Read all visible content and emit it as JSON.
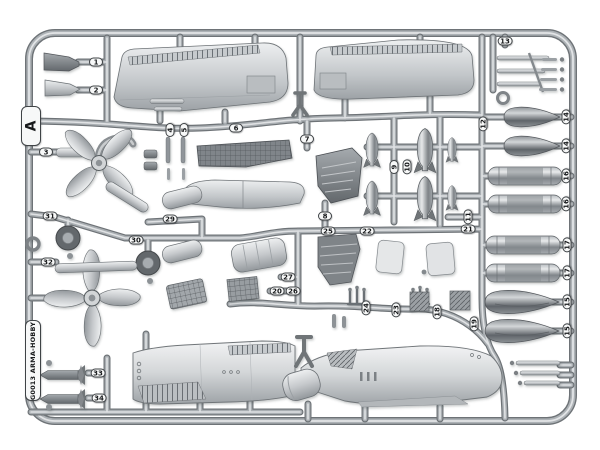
{
  "sprue": {
    "letter": "A",
    "product_code": "G0013 ARMA-HOBBY",
    "part_tags": [
      {
        "label": "1",
        "x": 96,
        "y": 62,
        "rot": 0
      },
      {
        "label": "2",
        "x": 96,
        "y": 90,
        "rot": 0
      },
      {
        "label": "3",
        "x": 46,
        "y": 152,
        "rot": 0
      },
      {
        "label": "4",
        "x": 170,
        "y": 130,
        "rot": 1
      },
      {
        "label": "5",
        "x": 184,
        "y": 130,
        "rot": 1
      },
      {
        "label": "6",
        "x": 236,
        "y": 128,
        "rot": 0
      },
      {
        "label": "7",
        "x": 307,
        "y": 139,
        "rot": 0
      },
      {
        "label": "8",
        "x": 325,
        "y": 216,
        "rot": 0
      },
      {
        "label": "9",
        "x": 394,
        "y": 167,
        "rot": 1
      },
      {
        "label": "10",
        "x": 407,
        "y": 167,
        "rot": 1
      },
      {
        "label": "11",
        "x": 468,
        "y": 217,
        "rot": 1
      },
      {
        "label": "12",
        "x": 483,
        "y": 124,
        "rot": 1
      },
      {
        "label": "13",
        "x": 505,
        "y": 41,
        "rot": 0
      },
      {
        "label": "14",
        "x": 566,
        "y": 117,
        "rot": 1
      },
      {
        "label": "14",
        "x": 566,
        "y": 146,
        "rot": 1
      },
      {
        "label": "16",
        "x": 566,
        "y": 176,
        "rot": 1
      },
      {
        "label": "16",
        "x": 566,
        "y": 204,
        "rot": 1
      },
      {
        "label": "17",
        "x": 567,
        "y": 245,
        "rot": 1
      },
      {
        "label": "17",
        "x": 567,
        "y": 273,
        "rot": 1
      },
      {
        "label": "15",
        "x": 567,
        "y": 302,
        "rot": 1
      },
      {
        "label": "15",
        "x": 567,
        "y": 331,
        "rot": 1
      },
      {
        "label": "21",
        "x": 468,
        "y": 229,
        "rot": 0
      },
      {
        "label": "25",
        "x": 328,
        "y": 231,
        "rot": 0
      },
      {
        "label": "22",
        "x": 367,
        "y": 231,
        "rot": 0
      },
      {
        "label": "27",
        "x": 288,
        "y": 277,
        "rot": 0
      },
      {
        "label": "20",
        "x": 277,
        "y": 291,
        "rot": 0
      },
      {
        "label": "26",
        "x": 293,
        "y": 291,
        "rot": 0
      },
      {
        "label": "24",
        "x": 366,
        "y": 308,
        "rot": 1
      },
      {
        "label": "23",
        "x": 396,
        "y": 310,
        "rot": 1
      },
      {
        "label": "18",
        "x": 437,
        "y": 312,
        "rot": 1
      },
      {
        "label": "19",
        "x": 474,
        "y": 324,
        "rot": 1
      },
      {
        "label": "29",
        "x": 170,
        "y": 219,
        "rot": 0
      },
      {
        "label": "30",
        "x": 136,
        "y": 240,
        "rot": 0
      },
      {
        "label": "31",
        "x": 50,
        "y": 216,
        "rot": 0
      },
      {
        "label": "32",
        "x": 48,
        "y": 262,
        "rot": 0
      },
      {
        "label": "33",
        "x": 98,
        "y": 373,
        "rot": 0
      },
      {
        "label": "34",
        "x": 99,
        "y": 398,
        "rot": 0
      }
    ],
    "colors": {
      "background": "#ffffff",
      "plastic_light": "#e8eaeb",
      "plastic_mid": "#aab0b4",
      "plastic_dark": "#6d7276",
      "tag_background": "#f7f8f8",
      "tag_border": "#3f4346"
    }
  }
}
